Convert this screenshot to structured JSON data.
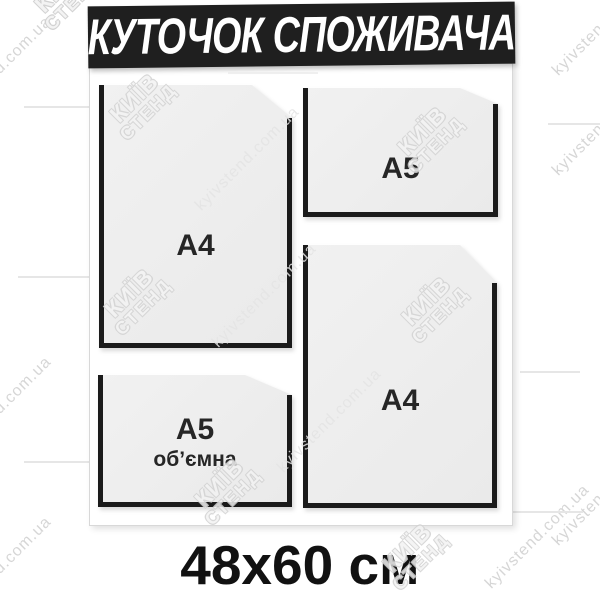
{
  "header": {
    "title": "КУТОЧОК СПОЖИВАЧА"
  },
  "pockets": [
    {
      "name": "a4-top-left",
      "label": "A4"
    },
    {
      "name": "a5-top-right",
      "label": "A5"
    },
    {
      "name": "a5-bottom-left",
      "label": "A5",
      "sublabel": "об’ємна"
    },
    {
      "name": "a4-bottom-right",
      "label": "A4"
    }
  ],
  "caption": {
    "size_label": "48x60 см"
  },
  "watermark": {
    "site_text": "kyivstend.com.ua",
    "logo_line1": "КИЇВ",
    "logo_line2": "СТЕНД"
  },
  "colors": {
    "banner_bg": "#1f1f1f",
    "banner_text": "#ffffff",
    "pocket_fill": "#ededed",
    "pocket_border": "#1b1b1b",
    "caption_text": "#111111",
    "watermark": "#d6d6d6"
  }
}
